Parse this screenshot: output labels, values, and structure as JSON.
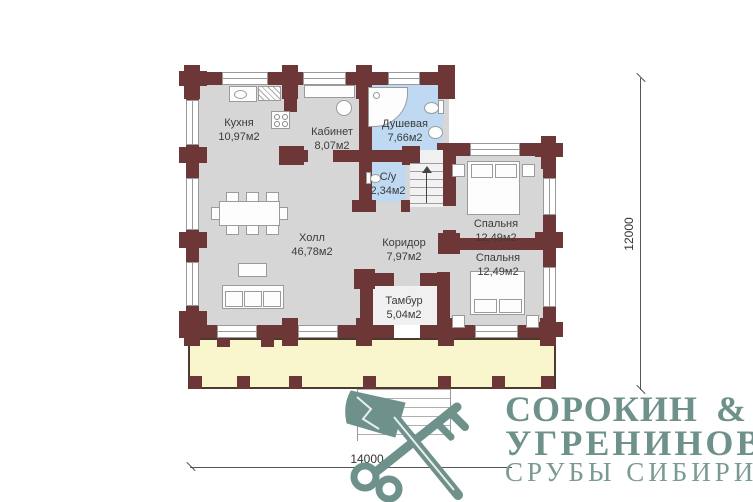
{
  "plan": {
    "rooms": [
      {
        "name": "Кухня",
        "area": "10,97м2"
      },
      {
        "name": "Кабинет",
        "area": "8,07м2"
      },
      {
        "name": "Душевая",
        "area": "7,66м2"
      },
      {
        "name": "С/у",
        "area": "2,34м2"
      },
      {
        "name": "Холл",
        "area": "46,78м2"
      },
      {
        "name": "Коридор",
        "area": "7,97м2"
      },
      {
        "name": "Спальня",
        "area": "12,49м2"
      },
      {
        "name": "Спальня",
        "area": "12,49м2"
      },
      {
        "name": "Тамбур",
        "area": "5,04м2"
      }
    ],
    "dimensions": {
      "width_mm": "14000",
      "height_mm": "12000"
    }
  },
  "logo": {
    "name_top": "СОРОКИН",
    "ampersand": "&",
    "name_bottom": "УГРЕНИНОВ",
    "tagline": "СРУБЫ СИБИРИ",
    "icon": "axe-and-key-icon"
  },
  "colors": {
    "wall": "#6e3737",
    "floor": "#d6d6d7",
    "wet_floor": "#bed9f1",
    "terrace": "#f9f5cd",
    "logo": "#6f918b",
    "furniture_border": "#9b9b9b"
  }
}
